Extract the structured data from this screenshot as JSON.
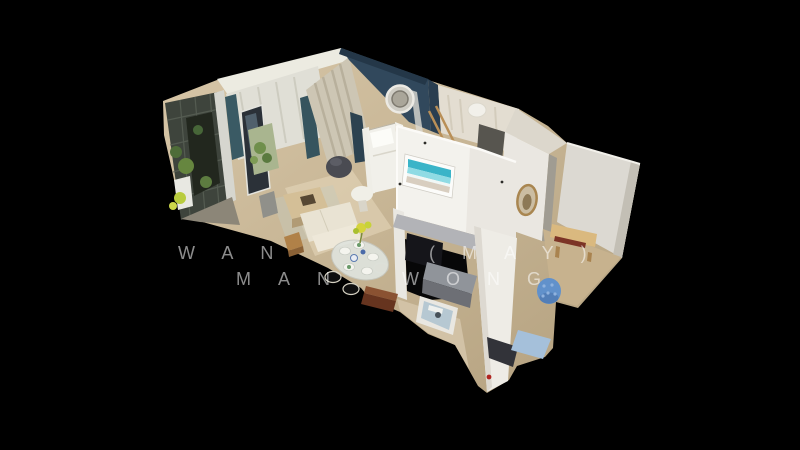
{
  "viewer": {
    "background_color": "#000000",
    "view_label": "3D dollhouse cutaway view of an apartment",
    "rooms_visible": [
      "balcony with plants",
      "living room",
      "dining area",
      "bedroom",
      "shower room",
      "bathroom",
      "second room"
    ]
  },
  "watermark": {
    "line1_left": "WAN",
    "line1_right": "(MAY)",
    "line2_left": "MAN",
    "line2_right": "WONG",
    "color": "#ffffff",
    "opacity": 0.55
  },
  "palette": {
    "floor_wood": "#cdb996",
    "walls_white": "#efeee9",
    "accent_wall_blue": "#31485c",
    "curtain_teal": "#3a5a64",
    "artwork_teal": "#3ab4c8",
    "pouf_blue": "#6191cb",
    "rug_blue": "#a5c0da",
    "bench_wood": "#dab97f",
    "plant_green": "#66863f",
    "scan_marker_red": "#b12420"
  }
}
